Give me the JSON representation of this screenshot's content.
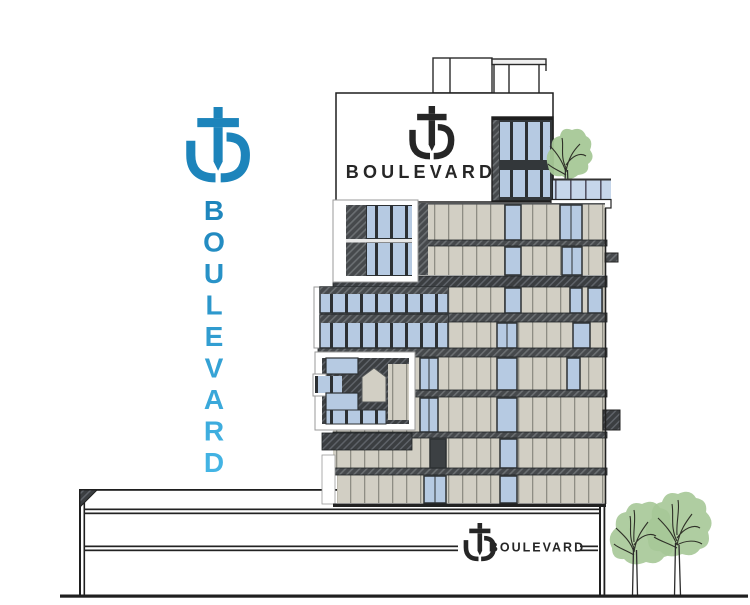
{
  "brand": {
    "name": "BOULEVARD",
    "vertical_letters": [
      "B",
      "O",
      "U",
      "L",
      "E",
      "V",
      "A",
      "R",
      "D"
    ],
    "logo": "anchor-trident-logo"
  },
  "building_sign": {
    "logo": "anchor-trident-logo",
    "label": "BOULEVARD"
  },
  "podium_sign": {
    "logo": "anchor-trident-logo",
    "label": "BOULEVARD"
  },
  "colors": {
    "brand_blue": "#1d84bb",
    "brand_cyan": "#45b6e6",
    "sign_dark": "#262626",
    "facade_beige": "#d2cfc4",
    "glass_blue": "#b6cae2",
    "frame_dark": "#2c3033",
    "hatch_dark": "#46494c",
    "tree_green": "#a6c897",
    "outline_dark": "#1f1f1f"
  }
}
